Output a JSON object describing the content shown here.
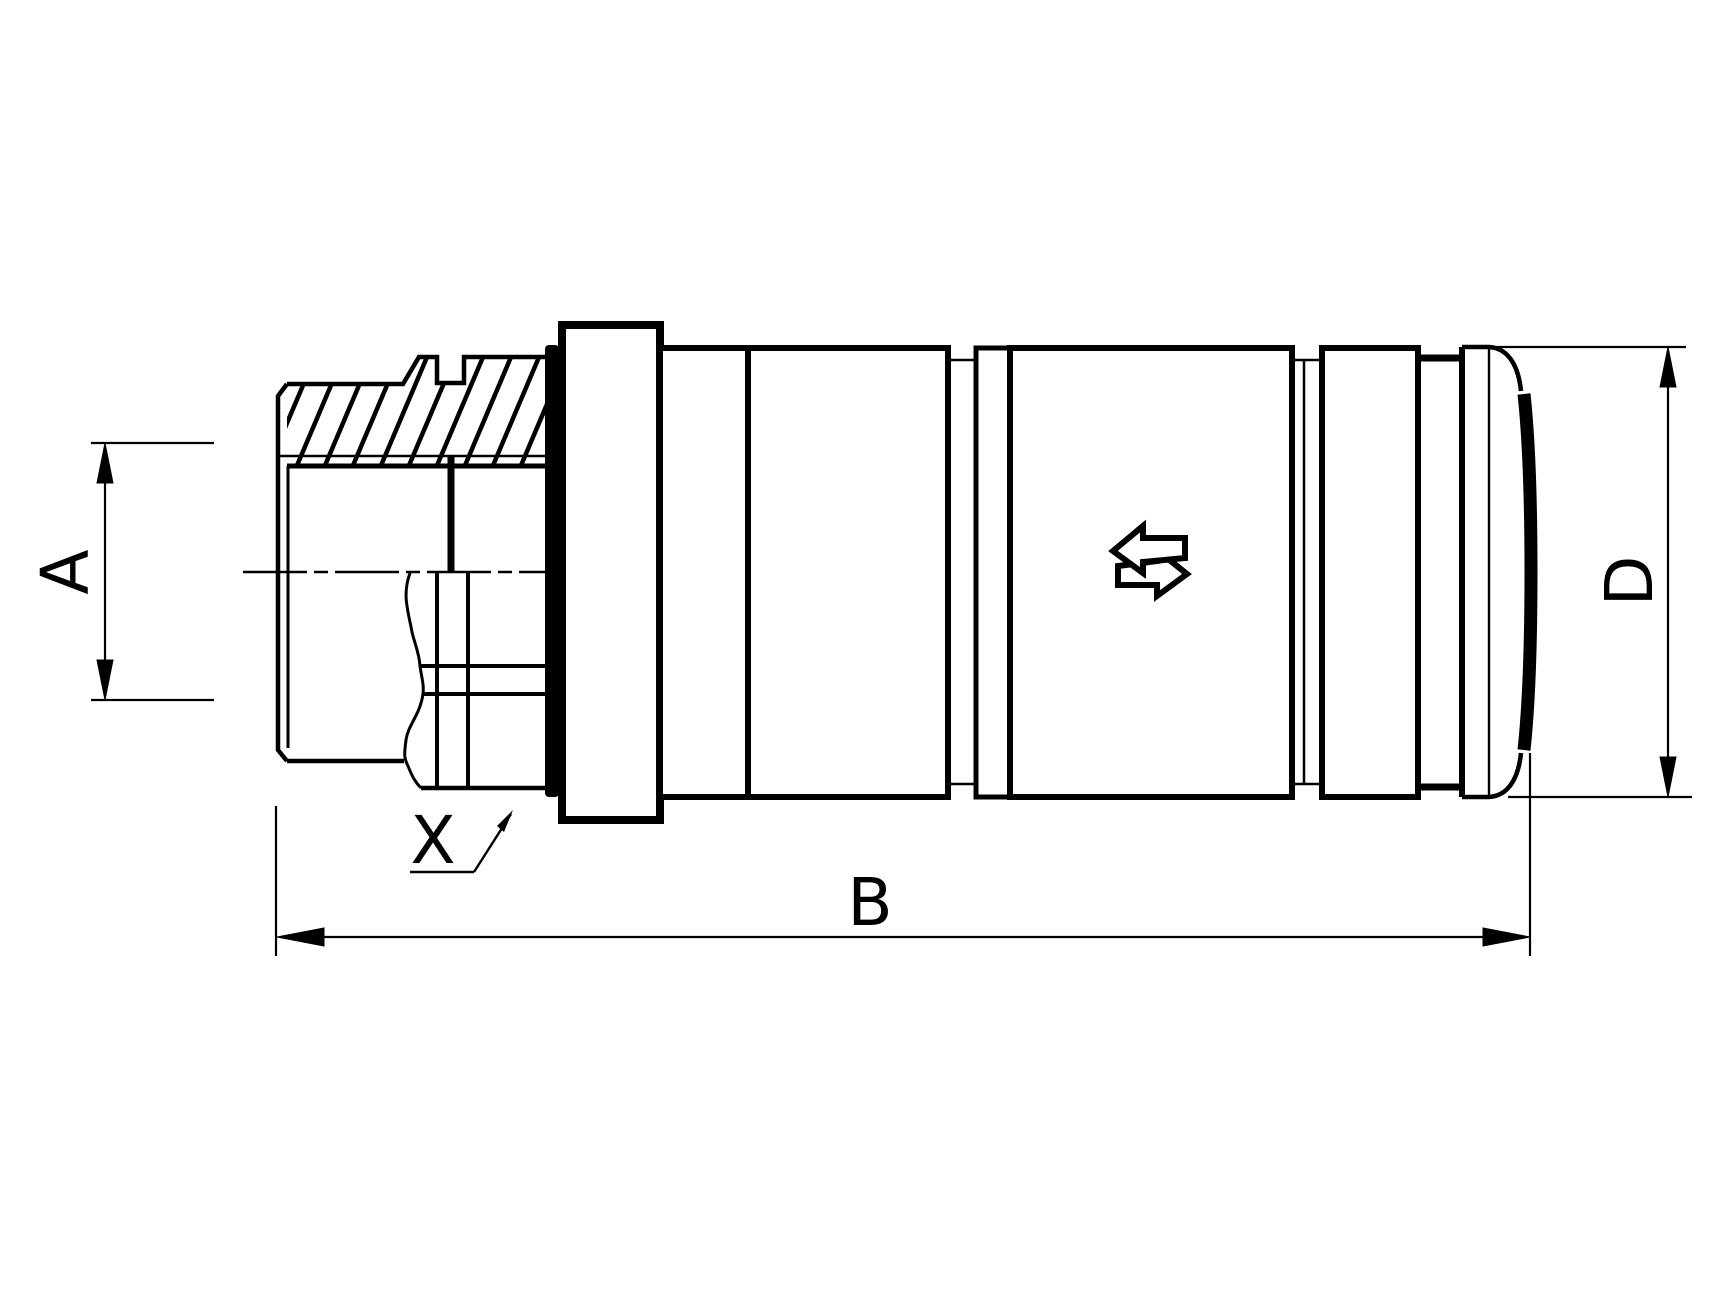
{
  "drawing": {
    "background_color": "#ffffff",
    "line_color": "#000000",
    "dimensions": {
      "a": {
        "label": "A",
        "orientation": "vertical-left"
      },
      "b": {
        "label": "B",
        "orientation": "horizontal-bottom"
      },
      "d": {
        "label": "D",
        "orientation": "vertical-right"
      }
    },
    "callouts": {
      "x": {
        "label": "X"
      }
    },
    "icons": [
      {
        "name": "bidirectional-flow-arrow-icon"
      }
    ]
  }
}
